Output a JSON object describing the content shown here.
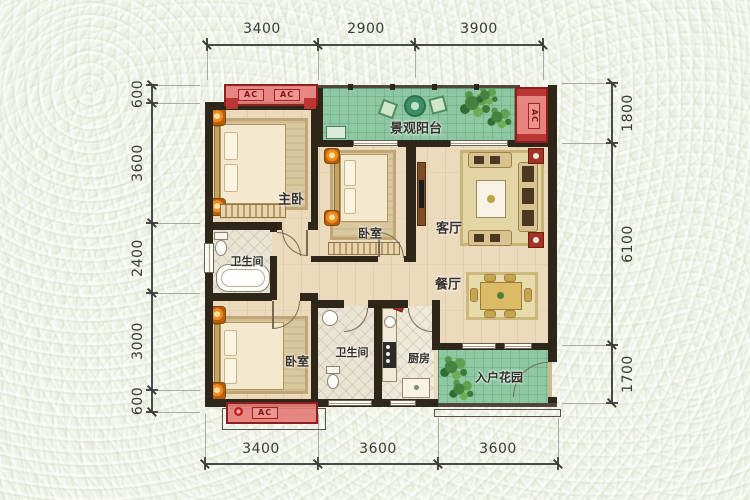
{
  "dimensions": {
    "top": [
      "3400",
      "2900",
      "3900"
    ],
    "bottom": [
      "3400",
      "3600",
      "3600"
    ],
    "left": [
      "600",
      "3600",
      "2400",
      "3000",
      "600"
    ],
    "right": [
      "1800",
      "6100",
      "1700"
    ]
  },
  "rooms": {
    "balcony": "景观阳台",
    "master_bedroom": "主卧",
    "bedroom_mid": "卧室",
    "living_room": "客厅",
    "dining_room": "餐厅",
    "bathroom_main": "卫生间",
    "bedroom_lower": "卧室",
    "bathroom_lower": "卫生间",
    "kitchen": "厨房",
    "entry_garden": "入户花园"
  },
  "ac_units": {
    "top_left_1": "AC",
    "top_left_2": "AC",
    "top_right": "AC",
    "bottom": "AC"
  },
  "colors": {
    "wall": "#2e2619",
    "wood_floor": "#ecdabd",
    "green_area": "#8dc8a2",
    "ac_red": "#e47d78",
    "accent_orange": "#f08c1e",
    "background": "#eef2e6",
    "dim_text": "#3a3a36"
  }
}
